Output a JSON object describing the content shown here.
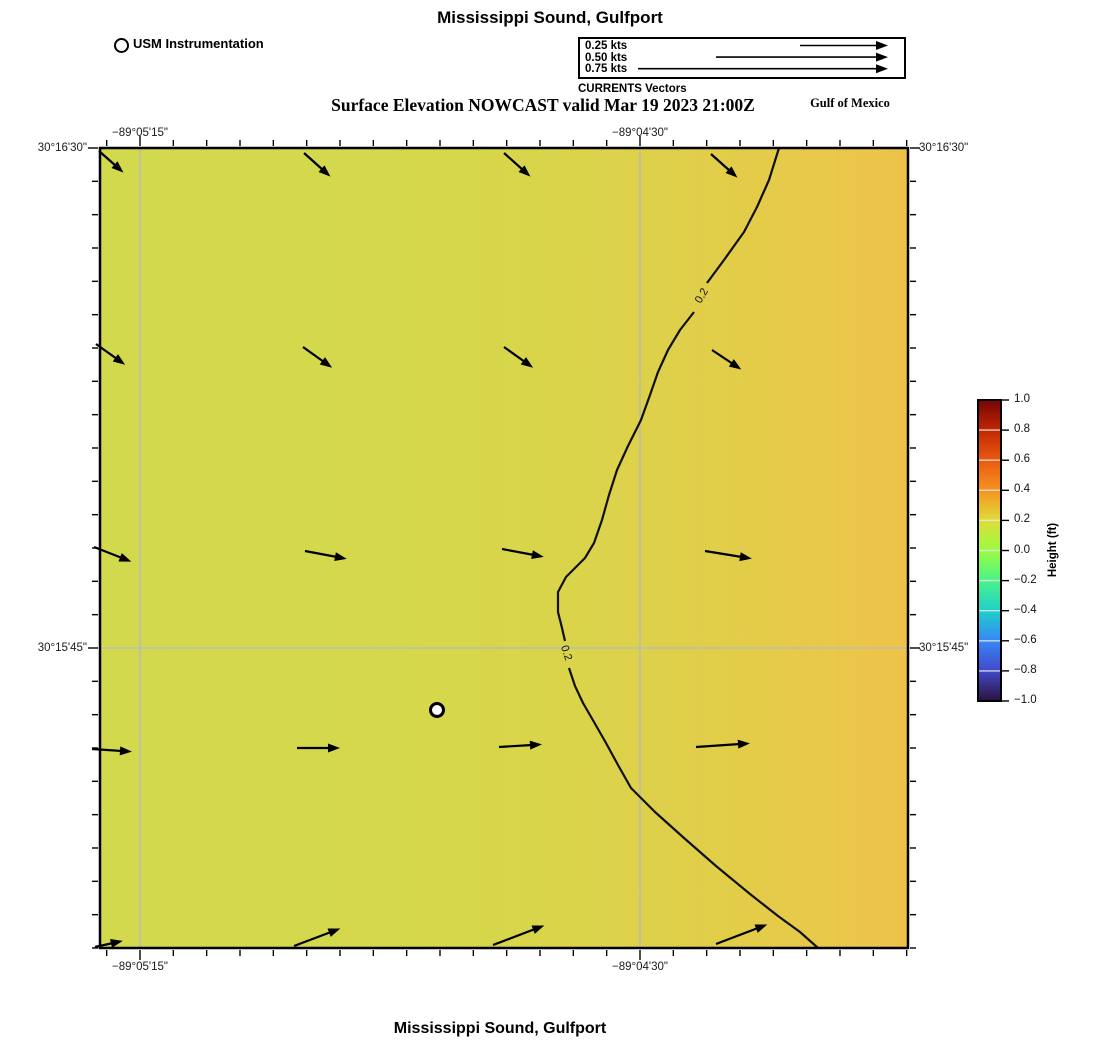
{
  "page": {
    "top_title": "Mississippi Sound, Gulfport",
    "subtitle": "Surface Elevation NOWCAST valid Mar 19 2023 21:00Z",
    "gulf_label": "Gulf of Mexico",
    "bottom_title": "Mississippi Sound, Gulfport"
  },
  "station_legend": {
    "label": "USM Instrumentation"
  },
  "vector_legend": {
    "caption": "CURRENTS Vectors",
    "items": [
      {
        "label": "0.25 kts",
        "speed_kts": 0.25,
        "arrow_len": 88
      },
      {
        "label": "0.50 kts",
        "speed_kts": 0.5,
        "arrow_len": 172
      },
      {
        "label": "0.75 kts",
        "speed_kts": 0.75,
        "arrow_len": 250
      }
    ]
  },
  "axes": {
    "x_ticks": [
      {
        "label": "−89°05'15\"",
        "px": 140
      },
      {
        "label": "−89°04'30\"",
        "px": 640
      }
    ],
    "y_ticks": [
      {
        "label": "30°16'30\"",
        "px": 148
      },
      {
        "label": "30°15'45\"",
        "px": 648
      }
    ]
  },
  "colorbar": {
    "label": "Height (ft)",
    "min": -1.0,
    "max": 1.0,
    "ticks": [
      "1.0",
      "0.8",
      "0.6",
      "0.4",
      "0.2",
      "0.0",
      "−0.2",
      "−0.4",
      "−0.6",
      "−0.8",
      "−1.0"
    ],
    "gradient": [
      {
        "at": 0.0,
        "color": "#750403"
      },
      {
        "at": 0.1,
        "color": "#c02803"
      },
      {
        "at": 0.2,
        "color": "#ea5a10"
      },
      {
        "at": 0.3,
        "color": "#f69320"
      },
      {
        "at": 0.4,
        "color": "#dfdc38"
      },
      {
        "at": 0.5,
        "color": "#9afc40"
      },
      {
        "at": 0.6,
        "color": "#4af387"
      },
      {
        "at": 0.7,
        "color": "#1fd0cb"
      },
      {
        "at": 0.8,
        "color": "#3787f6"
      },
      {
        "at": 0.9,
        "color": "#4149c8"
      },
      {
        "at": 1.0,
        "color": "#2c1240"
      }
    ]
  },
  "chart_data": {
    "type": "heatmap",
    "title": "Mississippi Sound, Gulfport",
    "subtitle": "Surface Elevation NOWCAST valid Mar 19 2023 21:00Z",
    "variable": "Surface elevation (ft)",
    "valid_time": "Mar 19 2023 21:00Z",
    "field_range_ft": [
      0.1,
      0.3
    ],
    "field_note": "elevation increases from ~0.1 ft (west, yellow-green) to ~0.3 ft (east, orange-yellow); 0.2 ft contour crosses map",
    "plot_box_px": [
      100,
      148,
      908,
      948
    ],
    "field_gradient": [
      {
        "at": 0.0,
        "color": "#d2d94d"
      },
      {
        "at": 0.45,
        "color": "#d6d74b"
      },
      {
        "at": 0.62,
        "color": "#dbd34b"
      },
      {
        "at": 0.78,
        "color": "#e2cd49"
      },
      {
        "at": 0.9,
        "color": "#e9c84a"
      },
      {
        "at": 1.0,
        "color": "#eec24a"
      }
    ],
    "grid": {
      "x_px": [
        140,
        640
      ],
      "y_px": [
        648
      ]
    },
    "ticks": {
      "minor_step_px": 33.333,
      "x_major_px": [
        140,
        640
      ],
      "y_major_px": [
        148,
        648
      ]
    },
    "contours": [
      {
        "level": 0.2,
        "segments": [
          [
            [
              779,
              148
            ],
            [
              769,
              180
            ],
            [
              757,
              207
            ],
            [
              744,
              232
            ],
            [
              724,
              260
            ],
            [
              707,
              283
            ]
          ],
          [
            [
              694,
              312
            ],
            [
              680,
              330
            ],
            [
              668,
              350
            ],
            [
              658,
              372
            ],
            [
              650,
              395
            ],
            [
              641,
              420
            ],
            [
              628,
              446
            ],
            [
              617,
              470
            ],
            [
              609,
              495
            ],
            [
              602,
              520
            ],
            [
              594,
              543
            ],
            [
              585,
              558
            ],
            [
              566,
              577
            ],
            [
              558,
              592
            ],
            [
              558,
              612
            ],
            [
              562,
              628
            ],
            [
              565,
              641
            ]
          ],
          [
            [
              569,
              668
            ],
            [
              575,
              686
            ],
            [
              583,
              703
            ],
            [
              594,
              722
            ],
            [
              606,
              743
            ],
            [
              618,
              765
            ],
            [
              631,
              788
            ],
            [
              655,
              812
            ],
            [
              684,
              838
            ],
            [
              716,
              866
            ],
            [
              750,
              894
            ],
            [
              778,
              916
            ],
            [
              800,
              932
            ],
            [
              818,
              948
            ]
          ]
        ],
        "labels": [
          {
            "text": "0.2",
            "x": 702,
            "y": 296,
            "rot": -59
          },
          {
            "text": "0.2",
            "x": 566,
            "y": 653,
            "rot": 72
          }
        ]
      }
    ],
    "vectors": {
      "units": "kts",
      "legend_speeds": [
        0.25,
        0.5,
        0.75
      ],
      "arrows_px": [
        [
          99,
          151,
          116,
          166
        ],
        [
          304,
          153,
          323,
          170
        ],
        [
          504,
          153,
          523,
          170
        ],
        [
          711,
          154,
          730,
          171
        ],
        [
          96,
          344,
          117,
          359
        ],
        [
          303,
          347,
          324,
          362
        ],
        [
          504,
          347,
          525,
          362
        ],
        [
          712,
          350,
          733,
          364
        ],
        [
          94,
          547,
          122,
          558
        ],
        [
          305,
          551,
          337,
          557
        ],
        [
          502,
          549,
          534,
          555
        ],
        [
          705,
          551,
          742,
          557
        ],
        [
          92,
          749,
          122,
          751
        ],
        [
          297,
          748,
          330,
          748
        ],
        [
          499,
          747,
          532,
          745
        ],
        [
          696,
          747,
          740,
          744
        ],
        [
          95,
          947,
          113,
          943
        ],
        [
          294,
          946,
          331,
          932
        ],
        [
          493,
          945,
          535,
          929
        ],
        [
          716,
          944,
          758,
          928
        ]
      ]
    },
    "station": {
      "name": "USM Instrumentation",
      "x_px": 437,
      "y_px": 710
    },
    "colorbar_geom": {
      "x": 978,
      "y": 400,
      "w": 23,
      "h": 301
    }
  }
}
